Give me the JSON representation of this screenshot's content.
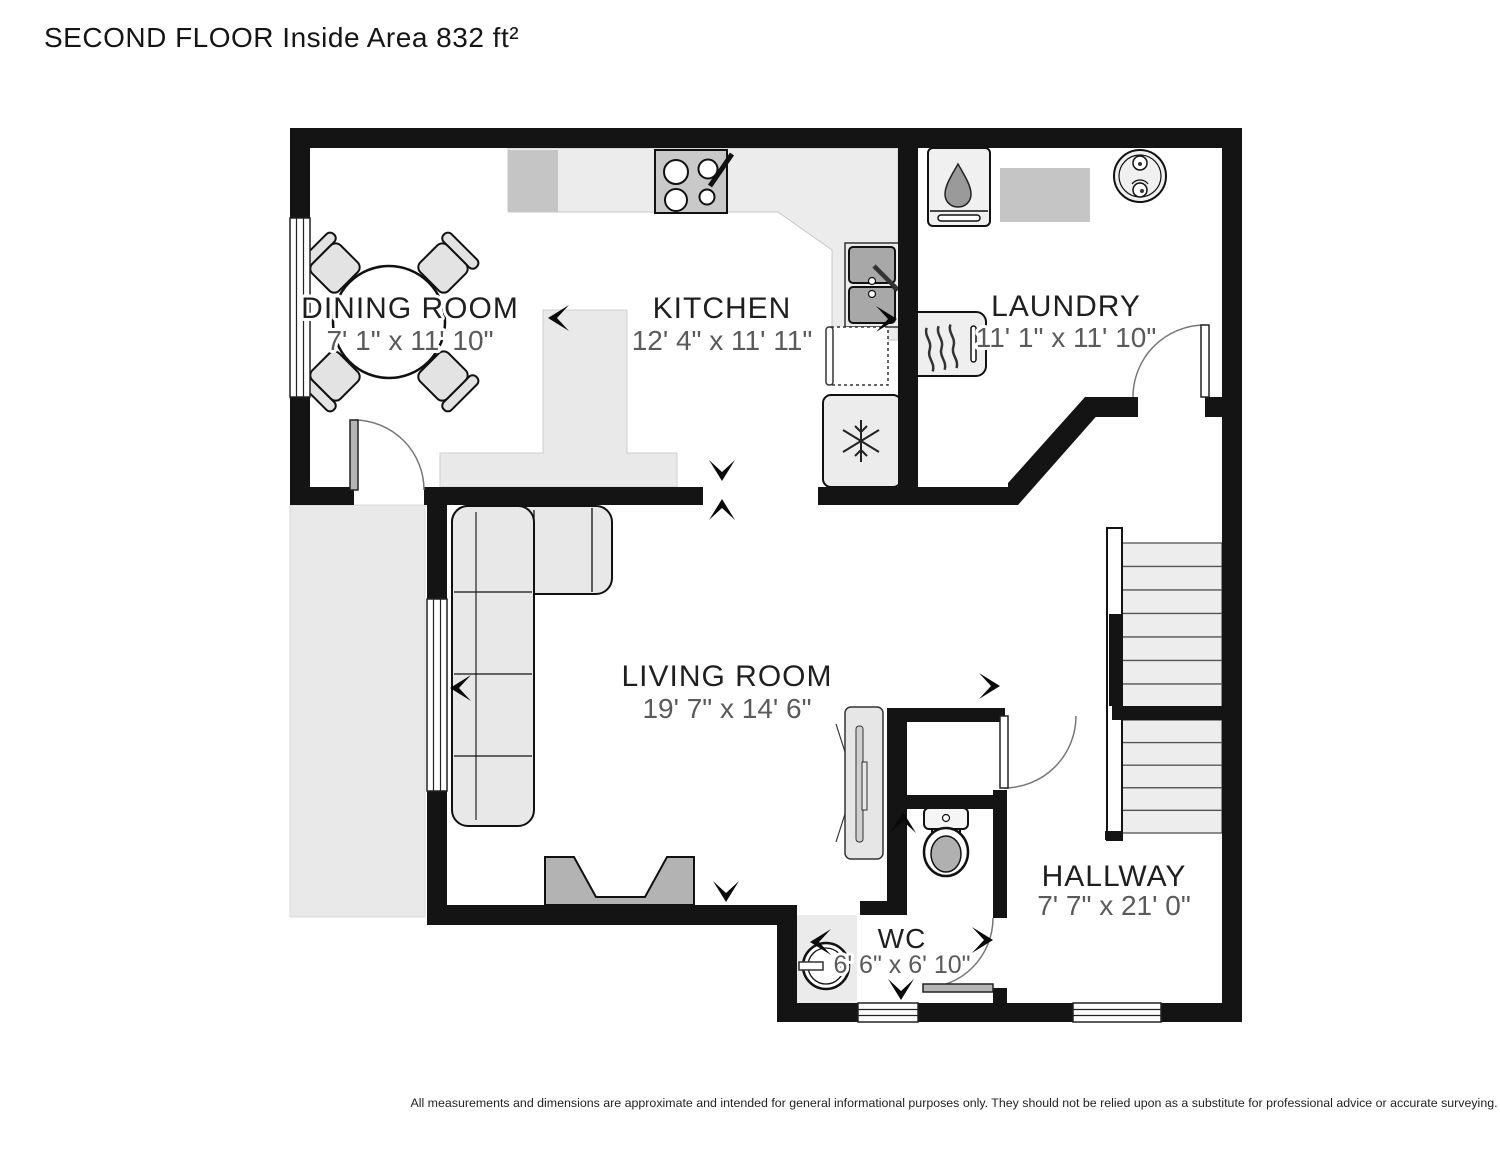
{
  "title": "SECOND FLOOR Inside Area 832 ft²",
  "disclaimer": "All measurements and dimensions are approximate and intended for general informational purposes only. They should not be relied upon as a substitute for professional advice or accurate surveying.",
  "rooms": [
    {
      "name": "DINING ROOM",
      "dims": "7' 1\" x 11' 10\""
    },
    {
      "name": "KITCHEN",
      "dims": "12' 4\" x 11' 11\""
    },
    {
      "name": "LAUNDRY",
      "dims": "11' 1\" x 11' 10\""
    },
    {
      "name": "LIVING ROOM",
      "dims": "19' 7\" x 14' 6\""
    },
    {
      "name": "HALLWAY",
      "dims": "7' 7\" x 21' 0\""
    },
    {
      "name": "WC",
      "dims": "6' 6\" x 6' 10\""
    }
  ],
  "colors": {
    "wall": "#141414",
    "counter": "#ececec",
    "counter_dark": "#c5c5c5",
    "fireplace": "#b3b3b3",
    "deck": "#e9e9e9",
    "label_text": "#1f1f1f",
    "dim_text": "#5a5a5a"
  },
  "fixtures": [
    "dining-table-icon",
    "dining-chair-icon",
    "stove-icon",
    "kitchen-sink-icon",
    "dishwasher-icon",
    "fridge-icon",
    "kitchen-island",
    "washer-icon",
    "dryer-icon",
    "washing-machine-icon",
    "laundry-counter",
    "sofa-icon",
    "fireplace-icon",
    "tv-unit-icon",
    "toilet-icon",
    "washbasin-icon",
    "stairs",
    "deck"
  ],
  "arrows": [
    {
      "x": 548,
      "y": 318,
      "dir": "left"
    },
    {
      "x": 897,
      "y": 319,
      "dir": "right"
    },
    {
      "x": 722,
      "y": 481,
      "dir": "down"
    },
    {
      "x": 722,
      "y": 499,
      "dir": "up"
    },
    {
      "x": 450,
      "y": 688,
      "dir": "left"
    },
    {
      "x": 1000,
      "y": 686,
      "dir": "right"
    },
    {
      "x": 726,
      "y": 902,
      "dir": "down"
    },
    {
      "x": 903,
      "y": 812,
      "dir": "up"
    },
    {
      "x": 810,
      "y": 942,
      "dir": "left"
    },
    {
      "x": 901,
      "y": 1000,
      "dir": "down"
    },
    {
      "x": 993,
      "y": 940,
      "dir": "right"
    }
  ]
}
